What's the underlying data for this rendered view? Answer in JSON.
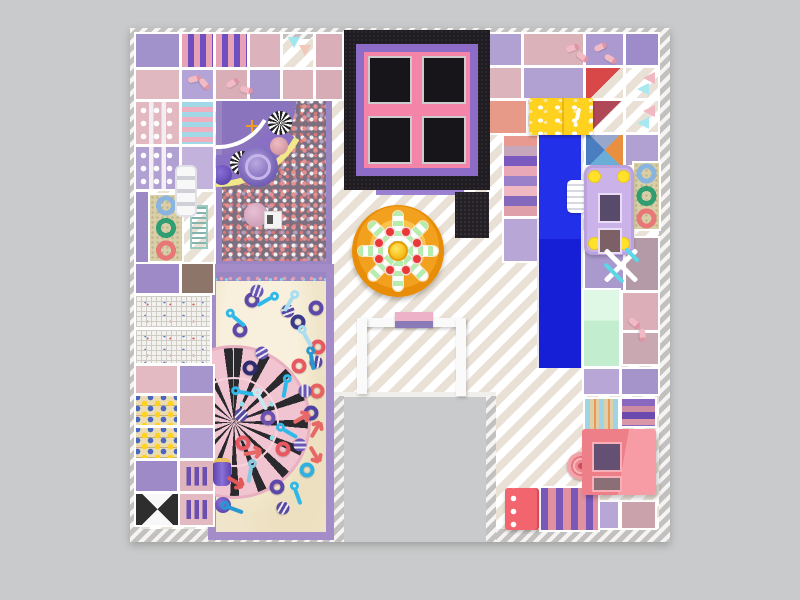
{
  "meta": {
    "description": "Top-down 3D render of an indoor soft-play playground floor plan",
    "canvas": {
      "w": 800,
      "h": 600
    }
  },
  "palette": {
    "background": "#c9cacb",
    "floor_white": "#ffffff",
    "floor_beige": "#e9e1d6",
    "wall_hatch_light": "#f5f4f2",
    "wall_hatch_gray": "#c3c1bf",
    "trampoline_black": "#1f1c22",
    "trampoline_purple": "#8d6cc8",
    "trampoline_pink": "#f585a8",
    "trampoline_bed": "#17151a",
    "flower_orange": "#f2a11f",
    "flower_hub_yellow": "#ffd318",
    "flower_spoke_green": "#b6ecae",
    "flower_seat_red": "#e83838",
    "gate_white": "#fafafa",
    "gate_sign_pink": "#eeb2c8",
    "gate_sign_purple": "#8a7ab8",
    "ballpit_frame": "#9b86c4",
    "ballpit_base": "#7b6f80",
    "slide_curved_purple": "#8a70c4",
    "slide_trim_yellow": "#f2e88a",
    "sand_frame": "#a48cc8",
    "sand": "#f0e5ca",
    "carousel_pink": "#f2a6ba",
    "carousel_stripe": "#2a2a2e",
    "slide_blue": "#2330ea",
    "cheese_yellow": "#ffd21f",
    "bus_purple": "#cbb2e8",
    "wheel_yellow": "#ffe12a",
    "mint_panel": "#c2eecf",
    "house_pink": "#ee7f88",
    "bench_red": "#f2646e",
    "ring_blue": "#8ab4e0",
    "ring_green": "#2f9e72",
    "ring_red": "#e87878",
    "tile_purple": "#a292cc",
    "tile_pink": "#dcb2bc",
    "tile_lavender": "#b1a0d2"
  },
  "structures": [
    {
      "name": "trampoline-park",
      "colors": [
        "#1f1c22",
        "#8d6cc8",
        "#f585a8",
        "#17151a"
      ]
    },
    {
      "name": "flower-spinner",
      "colors": [
        "#f2a11f",
        "#ffd318",
        "#b6ecae",
        "#e83838"
      ]
    },
    {
      "name": "entrance-gate",
      "colors": [
        "#fafafa",
        "#eeb2c8",
        "#8a7ab8"
      ]
    },
    {
      "name": "ball-pit",
      "colors": [
        "#9b86c4",
        "#7b6f80"
      ]
    },
    {
      "name": "curved-slide",
      "colors": [
        "#8a70c4",
        "#f2e88a"
      ]
    },
    {
      "name": "sand-pit",
      "colors": [
        "#a48cc8",
        "#f0e5ca"
      ]
    },
    {
      "name": "spinning-carousel",
      "colors": [
        "#f2a6ba",
        "#2a2a2e"
      ]
    },
    {
      "name": "straight-slide",
      "colors": [
        "#2330ea"
      ]
    },
    {
      "name": "stairs",
      "colors": [
        "#e89a90",
        "#7a5abf"
      ]
    },
    {
      "name": "cheese-box",
      "colors": [
        "#ffd21f"
      ]
    },
    {
      "name": "soft-play-bus",
      "colors": [
        "#cbb2e8",
        "#ffe12a"
      ]
    },
    {
      "name": "donut-ring-panel",
      "colors": [
        "#d8cfa8",
        "#8ab4e0",
        "#2f9e72",
        "#e87878"
      ]
    },
    {
      "name": "pinwheel-decor",
      "colors": [
        "#ffffff",
        "#5ad8e8"
      ]
    },
    {
      "name": "playhouse",
      "colors": [
        "#ee7f88"
      ]
    },
    {
      "name": "bench",
      "colors": [
        "#f2646e"
      ]
    },
    {
      "name": "piano-panel",
      "colors": [
        "#c2efe7"
      ]
    },
    {
      "name": "climb-ladder",
      "colors": [
        "#f8f8f8"
      ]
    }
  ],
  "flower": {
    "cx": 398,
    "cy": 251,
    "spoke_pairs": 4,
    "seats": 8,
    "seat_radius": 21,
    "seat_color": "#e83838"
  },
  "tiles": [
    [
      136,
      34,
      43,
      33,
      "solid",
      "#a292cc"
    ],
    [
      182,
      34,
      31,
      33,
      "rollerv",
      "#e8a2b6",
      "#6f4fc0"
    ],
    [
      216,
      34,
      31,
      33,
      "rollerv",
      "#e8a2b6",
      "#6f4fc0"
    ],
    [
      250,
      34,
      30,
      33,
      "solid",
      "#dcb2bc"
    ],
    [
      283,
      34,
      30,
      33,
      "pennant",
      "#9d8cc9"
    ],
    [
      316,
      34,
      26,
      33,
      "solid",
      "#d9aeb8"
    ],
    [
      136,
      70,
      43,
      29,
      "solid",
      "#e0b8c0"
    ],
    [
      182,
      70,
      31,
      29,
      "solid",
      "#b4a3d6"
    ],
    [
      216,
      70,
      31,
      29,
      "solid",
      "#d9aeb6"
    ],
    [
      250,
      70,
      30,
      29,
      "solid",
      "#a695cd"
    ],
    [
      283,
      70,
      30,
      29,
      "solid",
      "#dcb3bb"
    ],
    [
      316,
      70,
      26,
      29,
      "solid",
      "#d7acb6"
    ],
    [
      136,
      102,
      43,
      42,
      "poles",
      "#e2b9c1"
    ],
    [
      182,
      102,
      31,
      42,
      "rollerh",
      "#a0d8e8",
      "#f0afbf"
    ],
    [
      136,
      147,
      43,
      42,
      "poles",
      "#b1a0d2"
    ],
    [
      182,
      147,
      31,
      42,
      "solid",
      "#c3b2dc"
    ],
    [
      136,
      192,
      12,
      70,
      "solid",
      "#9b89c5"
    ],
    [
      150,
      195,
      32,
      66,
      "rings",
      "#d8cfa8"
    ],
    [
      184,
      192,
      30,
      70,
      "piano",
      "#c2efe7"
    ],
    [
      136,
      264,
      43,
      29,
      "solid",
      "#9d8ac6"
    ],
    [
      182,
      264,
      31,
      29,
      "solid",
      "#8d7669"
    ],
    [
      136,
      296,
      74,
      31,
      "mesh",
      "#f0eee8"
    ],
    [
      136,
      330,
      74,
      33,
      "mesh",
      "#e8eef0"
    ],
    [
      136,
      366,
      41,
      27,
      "solid",
      "#e4bac2"
    ],
    [
      180,
      366,
      33,
      27,
      "solid",
      "#a695cd"
    ],
    [
      136,
      396,
      41,
      29,
      "capsules",
      "#ecdcb2"
    ],
    [
      180,
      396,
      33,
      29,
      "solid",
      "#dfb3bc"
    ],
    [
      136,
      428,
      41,
      30,
      "capsules",
      "#ecdcb2"
    ],
    [
      180,
      428,
      33,
      30,
      "solid",
      "#af9ed2"
    ],
    [
      136,
      461,
      41,
      30,
      "solid",
      "#9d8ac6"
    ],
    [
      180,
      461,
      33,
      30,
      "slats",
      "#e0b4bd"
    ],
    [
      136,
      494,
      43,
      31,
      "xcross",
      "#f8f8f8",
      "#2e2e2e"
    ],
    [
      180,
      494,
      33,
      31,
      "slats",
      "#e4bac2"
    ],
    [
      490,
      34,
      31,
      31,
      "solid",
      "#b1a0d2"
    ],
    [
      524,
      34,
      59,
      31,
      "solid",
      "#dcb2ba"
    ],
    [
      586,
      34,
      37,
      31,
      "solid",
      "#ab99cf"
    ],
    [
      626,
      34,
      32,
      31,
      "solid",
      "#9d8cc9"
    ],
    [
      490,
      68,
      31,
      30,
      "solid",
      "#dcb4bc"
    ],
    [
      524,
      68,
      59,
      30,
      "solid",
      "#b1a0d2"
    ],
    [
      586,
      68,
      37,
      30,
      "tri3d",
      "#c8bfc9",
      "#d84848"
    ],
    [
      626,
      68,
      32,
      30,
      "pennant2",
      "#b4a4d4"
    ],
    [
      490,
      101,
      36,
      32,
      "solid",
      "#e89a88"
    ],
    [
      586,
      101,
      37,
      31,
      "tri3d",
      "#b8a8b4",
      "#b04858"
    ],
    [
      626,
      101,
      32,
      31,
      "pennant2",
      "#b4a4d4"
    ],
    [
      586,
      135,
      37,
      30,
      "mosaic",
      "#8878a8"
    ],
    [
      626,
      135,
      32,
      30,
      "solid",
      "#b1a0d2"
    ],
    [
      504,
      219,
      33,
      42,
      "solid",
      "#b7a6d6"
    ],
    [
      585,
      238,
      38,
      52,
      "solid",
      "#aa99cd"
    ],
    [
      626,
      238,
      32,
      52,
      "solid",
      "#b39aa6"
    ],
    [
      623,
      293,
      35,
      37,
      "solid",
      "#dcaeb8"
    ],
    [
      623,
      333,
      35,
      31,
      "solid",
      "#c9a8b2"
    ],
    [
      584,
      369,
      35,
      25,
      "solid",
      "#b7a6d6"
    ],
    [
      622,
      369,
      36,
      25,
      "solid",
      "#a494c9"
    ],
    [
      584,
      502,
      34,
      26,
      "solid",
      "#b7a6d6"
    ],
    [
      622,
      502,
      33,
      26,
      "solid",
      "#c9a2ac"
    ],
    [
      634,
      163,
      25,
      66,
      "rings",
      "#d8cfa8"
    ],
    [
      585,
      399,
      33,
      32,
      "rollerv2",
      "#9fd4e4",
      "#e0cfa6"
    ],
    [
      622,
      399,
      33,
      27,
      "steps",
      "#8a68c0",
      "#cc8ba0"
    ]
  ],
  "toys": [
    [
      "ring",
      252,
      300,
      "#5c48a8",
      0
    ],
    [
      "ring",
      298,
      322,
      "#3a3a8c",
      0
    ],
    [
      "ring",
      316,
      308,
      "#5c48a8",
      0
    ],
    [
      "ring",
      318,
      347,
      "#e85860",
      0
    ],
    [
      "ring",
      250,
      368,
      "#2c2c6e",
      0
    ],
    [
      "ring",
      299,
      366,
      "#e85860",
      0
    ],
    [
      "ring",
      268,
      418,
      "#6a50b0",
      0
    ],
    [
      "ring",
      243,
      443,
      "#e85860",
      0
    ],
    [
      "ring",
      283,
      449,
      "#e85860",
      0
    ],
    [
      "ring",
      311,
      413,
      "#5040a0",
      0
    ],
    [
      "ring",
      317,
      391,
      "#e86060",
      0
    ],
    [
      "ring",
      277,
      487,
      "#5c48a8",
      0
    ],
    [
      "ring",
      307,
      470,
      "#30b0e0",
      0
    ],
    [
      "ring",
      240,
      330,
      "#5c48a8",
      0
    ],
    [
      "ball",
      257,
      291,
      "#6a54b4",
      20
    ],
    [
      "ball",
      288,
      311,
      "#5848a0",
      70
    ],
    [
      "ball",
      305,
      391,
      "#6a54b4",
      0
    ],
    [
      "ball",
      241,
      415,
      "#5848a0",
      45
    ],
    [
      "ball",
      300,
      445,
      "#6a54b4",
      90
    ],
    [
      "ball",
      283,
      508,
      "#5848a0",
      30
    ],
    [
      "ball",
      262,
      353,
      "#6a54b4",
      60
    ],
    [
      "ball",
      316,
      362,
      "#5848a0",
      10
    ],
    [
      "key",
      236,
      318,
      "#30b8e8",
      40
    ],
    [
      "key",
      291,
      301,
      "#a8dff0",
      120
    ],
    [
      "key",
      243,
      392,
      "#30b8e8",
      10
    ],
    [
      "key",
      312,
      358,
      "#2898d0",
      80
    ],
    [
      "key",
      261,
      399,
      "#c8e8f0",
      60
    ],
    [
      "key",
      287,
      431,
      "#30b8e8",
      30
    ],
    [
      "key",
      251,
      471,
      "#88c8e0",
      100
    ],
    [
      "key",
      297,
      493,
      "#30b8e8",
      70
    ],
    [
      "key",
      232,
      508,
      "#2898d0",
      20
    ],
    [
      "key",
      268,
      300,
      "#30b8e8",
      150
    ],
    [
      "key",
      306,
      336,
      "#a8dff0",
      60
    ],
    [
      "key",
      286,
      386,
      "#30b8e8",
      100
    ],
    [
      "wrench",
      315,
      431,
      "#e86868",
      30
    ],
    [
      "wrench",
      251,
      453,
      "#e86868",
      80
    ],
    [
      "wrench",
      234,
      481,
      "#e05858",
      120
    ],
    [
      "wrench",
      314,
      453,
      "#e86868",
      150
    ],
    [
      "wrench",
      300,
      419,
      "#e86868",
      60
    ]
  ],
  "de_pills": [
    [
      188,
      76,
      -15
    ],
    [
      198,
      81,
      50
    ],
    [
      226,
      80,
      -30
    ],
    [
      240,
      87,
      15
    ],
    [
      566,
      45,
      -20
    ],
    [
      576,
      54,
      35
    ],
    [
      594,
      44,
      -25
    ],
    [
      604,
      56,
      30
    ],
    [
      628,
      320,
      40
    ],
    [
      636,
      332,
      85
    ]
  ]
}
